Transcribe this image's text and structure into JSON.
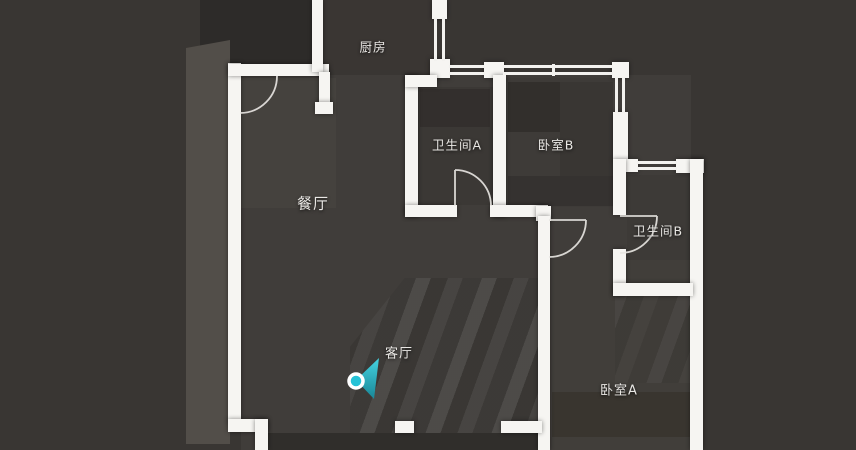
{
  "floorplan": {
    "room_labels": [
      {
        "name": "kitchen",
        "label": "厨房"
      },
      {
        "name": "bathroom-a",
        "label": "卫生间A"
      },
      {
        "name": "bedroom-b",
        "label": "卧室B"
      },
      {
        "name": "dining-room",
        "label": "餐厅"
      },
      {
        "name": "bathroom-b",
        "label": "卫生间B"
      },
      {
        "name": "living-room",
        "label": "客厅"
      },
      {
        "name": "bedroom-a",
        "label": "卧室A"
      }
    ],
    "camera_marker": {
      "located_room": "客厅",
      "x": 356,
      "y": 381,
      "facing": "east",
      "color": "#25c2d6"
    },
    "colors": {
      "wall": "#f6f5f2",
      "background": "#393633",
      "label": "#e9e7e4",
      "marker_accent": "#25c2d6"
    }
  }
}
